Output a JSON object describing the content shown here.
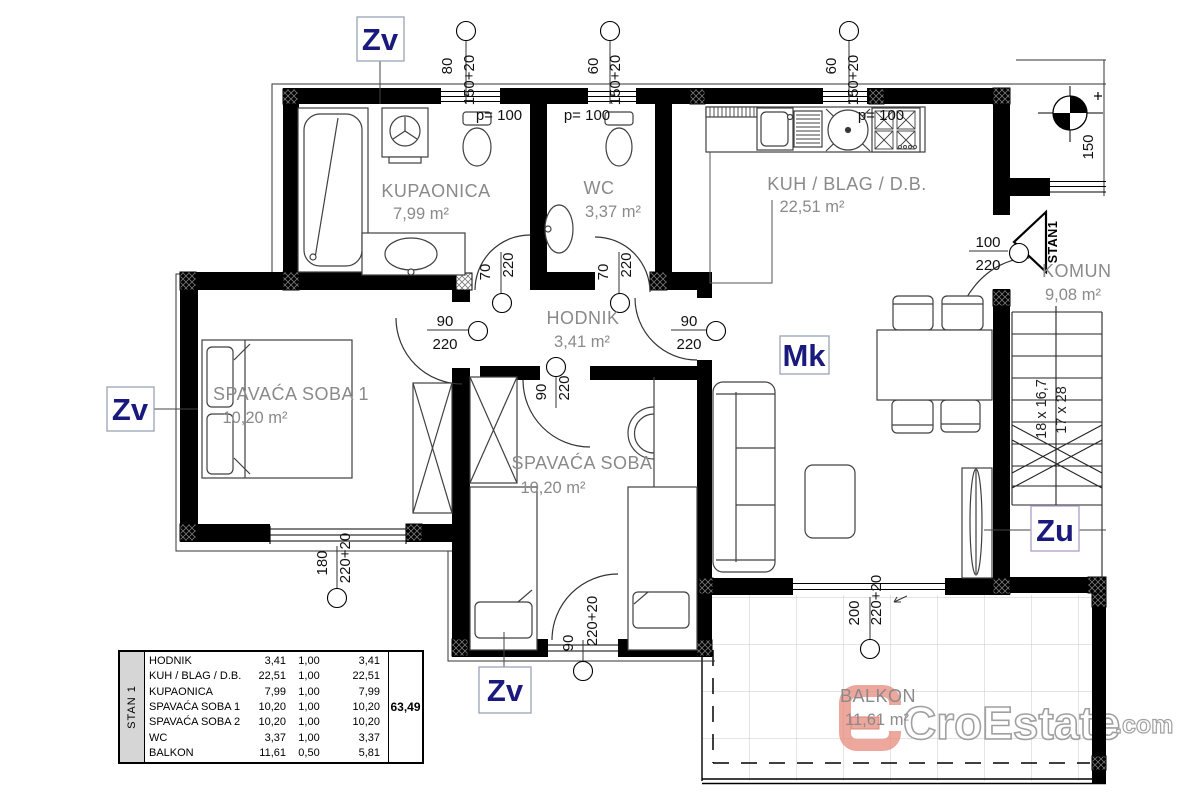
{
  "markers": {
    "zv": "Zv",
    "mk": "Mk",
    "zu": "Zu",
    "stan1": "STAN1"
  },
  "rooms": [
    {
      "name": "KUPAONICA",
      "area": "7,99  m²"
    },
    {
      "name": "WC",
      "area": "3,37  m²"
    },
    {
      "name": "KUH / BLAG / D.B.",
      "area": "22,51  m²"
    },
    {
      "name": "HODNIK",
      "area": "3,41  m²"
    },
    {
      "name": "SPAVAĆA SOBA 1",
      "area": "10,20  m²"
    },
    {
      "name": "SPAVAĆA SOBA",
      "area": "10,20  m²"
    },
    {
      "name": "KOMUN",
      "area": "9,08  m²"
    },
    {
      "name": "BALKON",
      "area": "11,61  m²"
    }
  ],
  "dims": {
    "w80": "80",
    "w60": "60",
    "w150_20": "150+20",
    "p100": "p= 100",
    "d70": "70",
    "d90": "90",
    "d100": "100",
    "d150": "150",
    "d180": "180",
    "d200": "200",
    "d220": "220",
    "d220_20": "220+20",
    "stairs_riser": "18 x 16,7",
    "stairs_tread": "17 x 28"
  },
  "area_table": {
    "row_group": "STAN 1",
    "rows": [
      {
        "name": "HODNIK",
        "area": "3,41",
        "coef": "1,00",
        "value": "3,41"
      },
      {
        "name": "KUH / BLAG / D.B.",
        "area": "22,51",
        "coef": "1,00",
        "value": "22,51"
      },
      {
        "name": "KUPAONICA",
        "area": "7,99",
        "coef": "1,00",
        "value": "7,99"
      },
      {
        "name": "SPAVAĆA SOBA 1",
        "area": "10,20",
        "coef": "1,00",
        "value": "10,20"
      },
      {
        "name": "SPAVAĆA SOBA 2",
        "area": "10,20",
        "coef": "1,00",
        "value": "10,20"
      },
      {
        "name": "WC",
        "area": "3,37",
        "coef": "1,00",
        "value": "3,37"
      },
      {
        "name": "BALKON",
        "area": "11,61",
        "coef": "0,50",
        "value": "5,81"
      }
    ],
    "total": "63,49"
  },
  "watermark": {
    "brand": "CroEstate",
    "tld": ".com"
  },
  "colors": {
    "wall": "#000000",
    "room_label": "#8a8a8a",
    "marker_text": "#1a1a7e",
    "logo": "#e8897d"
  }
}
